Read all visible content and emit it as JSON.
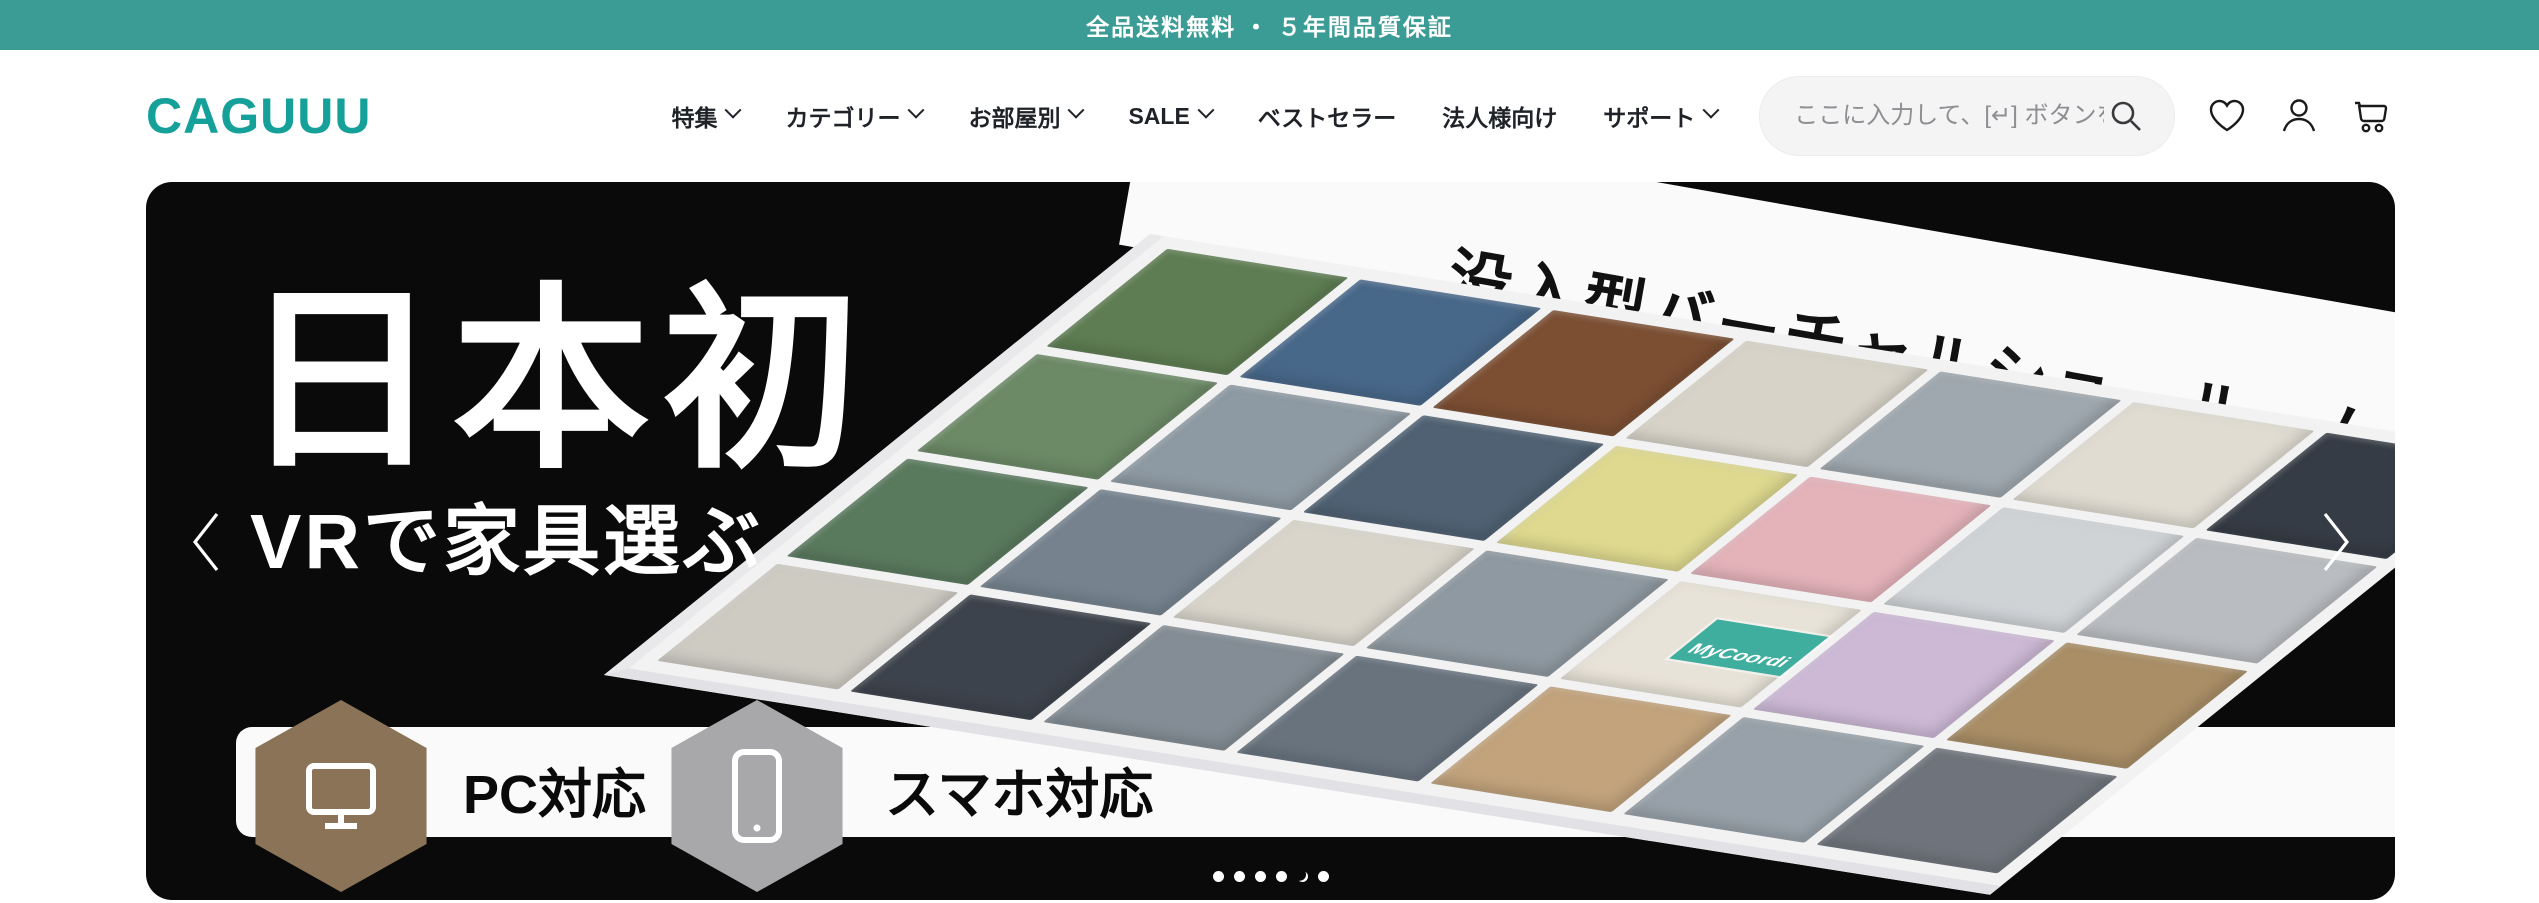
{
  "banner": {
    "text": "全品送料無料 ・ ５年間品質保証",
    "bg_color": "#3b9c95"
  },
  "header": {
    "logo": "CAGUUU",
    "logo_color": "#15a099",
    "nav": [
      {
        "label": "特集",
        "has_dropdown": true
      },
      {
        "label": "カテゴリー",
        "has_dropdown": true
      },
      {
        "label": "お部屋別",
        "has_dropdown": true
      },
      {
        "label": "SALE",
        "has_dropdown": true
      },
      {
        "label": "ベストセラー",
        "has_dropdown": false
      },
      {
        "label": "法人様向け",
        "has_dropdown": false
      },
      {
        "label": "サポート",
        "has_dropdown": true
      }
    ],
    "search": {
      "placeholder": "ここに入力して、[↵] ボタンをタップ",
      "icon": "search-icon"
    },
    "action_icons": [
      "wishlist-heart-icon",
      "account-user-icon",
      "cart-icon"
    ]
  },
  "hero": {
    "bg_color": "#0a0a0a",
    "title": "日本初",
    "subtitle": "VRで家具選ぶ",
    "ribbon_text": "没入型バーチャルショールーム",
    "badges": [
      {
        "label": "PC対応",
        "icon": "monitor-icon",
        "hex_color": "#8a7356"
      },
      {
        "label": "スマホ対応",
        "icon": "smartphone-icon",
        "hex_color": "#a8a8ab"
      }
    ],
    "floorplan": {
      "tag": "MyCoordi",
      "tag_color": "#3fae9e",
      "rooms": [
        "#5e7d52",
        "#48688a",
        "#7c4f33",
        "#d7d3c8",
        "#9fa8af",
        "#e0dcd2",
        "#363c45",
        "#6c8a66",
        "#8e9aa3",
        "#4f6173",
        "#ded98f",
        "#e4b3ba",
        "#cfd3d6",
        "#b9bcc0",
        "#5a7a5e",
        "#76838f",
        "#d9d5cb",
        "#8f99a1",
        "#e8e3d8",
        "#cdb9d6",
        "#a98e66",
        "#cecbc3",
        "#3d434c",
        "#848d95",
        "#68737e",
        "#c2a37c",
        "#98a1a9",
        "#6f747c"
      ]
    },
    "carousel": {
      "dot_count": 6,
      "crescent_index": 4
    }
  }
}
